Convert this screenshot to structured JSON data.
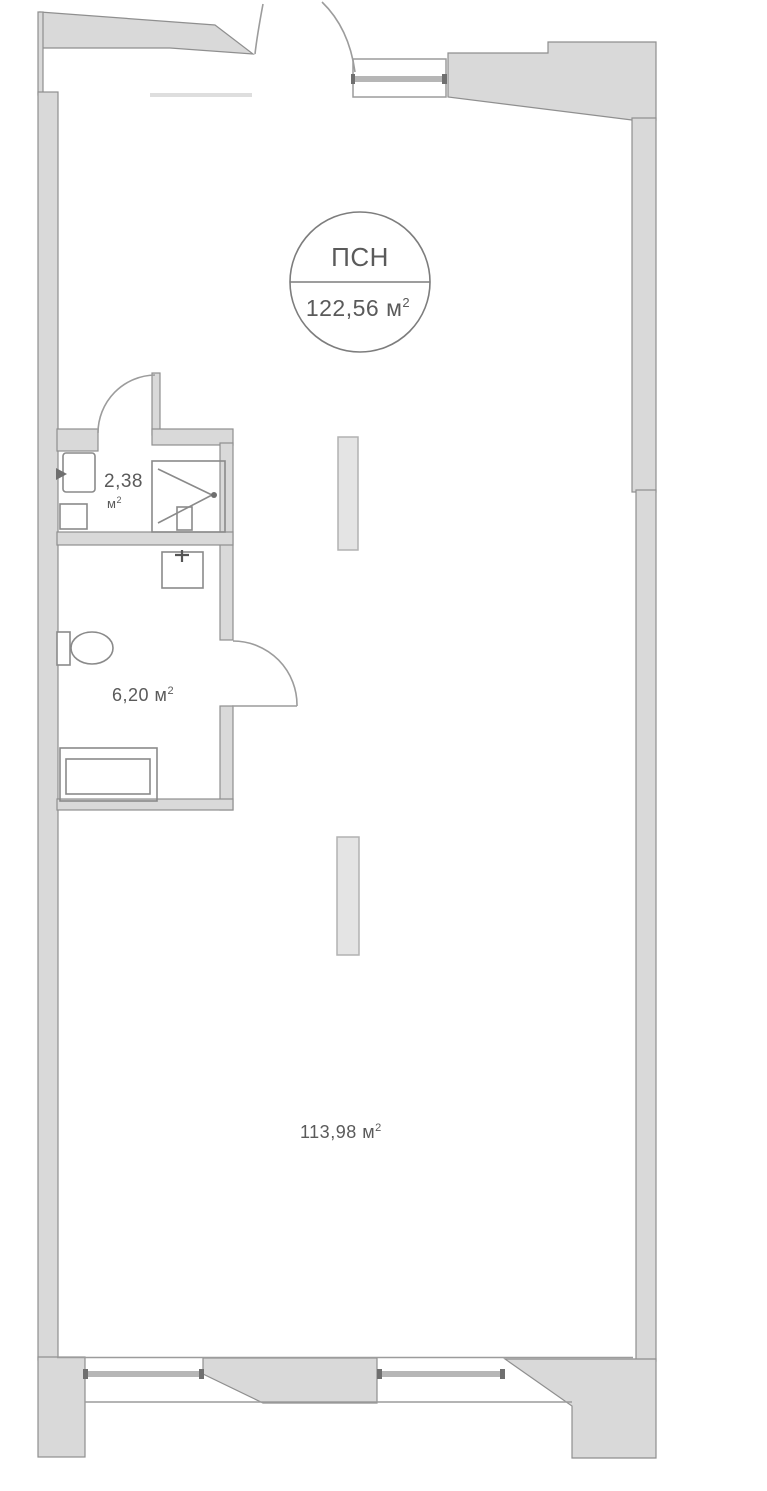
{
  "page": {
    "background": "#ffffff"
  },
  "colors": {
    "background": "#ffffff",
    "wall_fill": "#d9d9d9",
    "wall_stroke": "#8f8f8f",
    "line": "#9c9c9c",
    "line_light": "#b6b6b6",
    "line_faint": "#dedede",
    "tick_dark": "#6f6f6f",
    "fixture_stroke": "#8a8a8a",
    "column_fill": "#e4e4e4",
    "column_stroke": "#b2b2b2",
    "circle_stroke": "#7d7d7d",
    "text": "#5a5a5a"
  },
  "unit_badge": {
    "title": "ПСН",
    "area_value": "122,56",
    "area_unit": " м",
    "area_sup": "2"
  },
  "rooms": {
    "bathroom": {
      "area_value": "2,38",
      "unit": "м",
      "sup": "2"
    },
    "wc": {
      "area_value": "6,20",
      "unit": " м",
      "sup": "2"
    },
    "main": {
      "area_value": "113,98",
      "unit": " м",
      "sup": "2"
    }
  }
}
